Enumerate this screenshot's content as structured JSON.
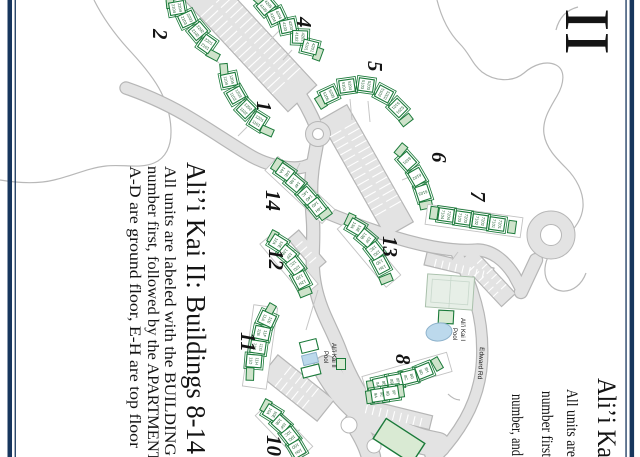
{
  "page": {
    "width": 640,
    "height": 457,
    "background": "#ffffff",
    "rotation_note": "portrait scan rotated 90deg clockwise"
  },
  "colors": {
    "border_navy": "#17365d",
    "building_green": "#1b7a3a",
    "unit_text_green": "#1d5c2f",
    "cap_green_fill": "#cfe3cb",
    "light_green_fill": "#d9ead3",
    "road_fill": "#e3e3e3",
    "road_casing": "#b6b6b6",
    "coast_gray": "#b8b8b8",
    "pool_blue": "#bcd9ec",
    "text_black": "#141414"
  },
  "left_legend": {
    "title": "Ali’i Kai II: Buildings 8-14",
    "lines": [
      "All units are labeled with the BUILDING",
      "number first, followed by the APARTMENT",
      "A-D are ground floor, E-H are top floor"
    ]
  },
  "right_page_fragment": {
    "numeral": "II",
    "title": "Ali’i Ka",
    "lines": [
      "All units are",
      "number first",
      "number, and"
    ]
  },
  "map_labels": {
    "pool1": [
      "Ali’i Kai I",
      "Pool"
    ],
    "pool2": [
      "Ali’i Kai II",
      "Pool"
    ],
    "road": "Edward Rd"
  },
  "labels": [
    {
      "name": "left-title",
      "text": "Ali’i Kai II: Buildings 8-14",
      "x": 187,
      "y": 162,
      "fs": 27,
      "rot": 90,
      "len": 292
    },
    {
      "name": "left-line-1",
      "text": "All units are labeled with the BUILDING",
      "x": 165,
      "y": 166,
      "fs": 15.5,
      "rot": 90,
      "len": 290
    },
    {
      "name": "left-line-2",
      "text": "number first, followed by the APARTMENT",
      "x": 148,
      "y": 166,
      "fs": 15.5,
      "rot": 90,
      "len": 296
    },
    {
      "name": "left-line-3",
      "text": "A-D are ground floor, E-H are top floor",
      "x": 130,
      "y": 166,
      "fs": 15.5,
      "rot": 90,
      "len": 282
    },
    {
      "name": "right-numeral",
      "text": "II",
      "x": 566,
      "y": 8,
      "fs": 64,
      "rot": 90,
      "len": 47
    },
    {
      "name": "right-title",
      "text": "Ali’i Ka",
      "x": 598,
      "y": 378,
      "fs": 26,
      "rot": 90,
      "len": 80
    },
    {
      "name": "right-line-1",
      "text": "All units are",
      "x": 567,
      "y": 389,
      "fs": 15.5,
      "rot": 90,
      "len": 68
    },
    {
      "name": "right-line-2",
      "text": "number first",
      "x": 542,
      "y": 391,
      "fs": 15.5,
      "rot": 90,
      "len": 66
    },
    {
      "name": "right-line-3",
      "text": "number, and",
      "x": 512,
      "y": 394,
      "fs": 15.5,
      "rot": 90,
      "len": 62
    },
    {
      "name": "bnum-2",
      "text": "2",
      "x": 153,
      "y": 29,
      "fs": 21,
      "rot": 90,
      "b": 1,
      "it": 1
    },
    {
      "name": "bnum-1",
      "text": "1",
      "x": 257,
      "y": 101,
      "fs": 21,
      "rot": 90,
      "b": 1,
      "it": 1
    },
    {
      "name": "bnum-4",
      "text": "4",
      "x": 297,
      "y": 17,
      "fs": 21,
      "rot": 90,
      "b": 1,
      "it": 1
    },
    {
      "name": "bnum-5",
      "text": "5",
      "x": 368,
      "y": 61,
      "fs": 21,
      "rot": 90,
      "b": 1,
      "it": 1
    },
    {
      "name": "bnum-6",
      "text": "6",
      "x": 432,
      "y": 152,
      "fs": 21,
      "rot": 90,
      "b": 1,
      "it": 1
    },
    {
      "name": "bnum-7",
      "text": "7",
      "x": 471,
      "y": 191,
      "fs": 21,
      "rot": 90,
      "b": 1,
      "it": 1
    },
    {
      "name": "bnum-14",
      "text": "14",
      "x": 266,
      "y": 190,
      "fs": 21,
      "rot": 90,
      "b": 1,
      "it": 1
    },
    {
      "name": "bnum-12",
      "text": "12",
      "x": 269,
      "y": 249,
      "fs": 21,
      "rot": 90,
      "b": 1,
      "it": 1
    },
    {
      "name": "bnum-13",
      "text": "13",
      "x": 383,
      "y": 236,
      "fs": 21,
      "rot": 90,
      "b": 1,
      "it": 1
    },
    {
      "name": "bnum-11",
      "text": "11",
      "x": 241,
      "y": 332,
      "fs": 21,
      "rot": 90,
      "b": 1,
      "it": 1
    },
    {
      "name": "bnum-8",
      "text": "8",
      "x": 396,
      "y": 354,
      "fs": 21,
      "rot": 90,
      "b": 1,
      "it": 1
    },
    {
      "name": "bnum-10",
      "text": "10",
      "x": 267,
      "y": 435,
      "fs": 21,
      "rot": 90,
      "b": 1,
      "it": 1
    },
    {
      "name": "pool1-label-1",
      "text": "Ali’i Kai I",
      "x": 461,
      "y": 318,
      "fs": 6,
      "rot": 90,
      "sans": 1
    },
    {
      "name": "pool1-label-2",
      "text": "Pool",
      "x": 453,
      "y": 328,
      "fs": 6,
      "rot": 90,
      "sans": 1
    },
    {
      "name": "pool2-label-1",
      "text": "Ali’i Kai II",
      "x": 332,
      "y": 343,
      "fs": 6,
      "rot": 90,
      "sans": 1
    },
    {
      "name": "pool2-label-2",
      "text": "Pool",
      "x": 324,
      "y": 351,
      "fs": 6,
      "rot": 90,
      "sans": 1
    },
    {
      "name": "edward-rd-label",
      "text": "Edward Rd",
      "x": 480,
      "y": 347,
      "fs": 6.5,
      "rot": 94,
      "sans": 1
    }
  ],
  "buildings": [
    {
      "id": "1",
      "units": [
        {
          "x": 229,
          "y": 80,
          "a": -12,
          "lines": [
            "1104",
            "1204"
          ]
        },
        {
          "x": 236,
          "y": 95,
          "a": -30,
          "lines": [
            "1103",
            "1203"
          ]
        },
        {
          "x": 246,
          "y": 109,
          "a": -45,
          "lines": [
            "1102",
            "1202"
          ]
        },
        {
          "x": 258,
          "y": 121,
          "a": -58,
          "lines": [
            "1101",
            "1201"
          ]
        }
      ],
      "caps": [
        {
          "x": 224,
          "y": 70,
          "a": -5
        },
        {
          "x": 267,
          "y": 131,
          "a": -66
        }
      ]
    },
    {
      "id": "2",
      "units": [
        {
          "x": 177,
          "y": 8,
          "a": -10,
          "lines": [
            "2104",
            "2204"
          ]
        },
        {
          "x": 187,
          "y": 19,
          "a": -25,
          "lines": [
            "2103",
            "2203"
          ]
        },
        {
          "x": 198,
          "y": 31,
          "a": -40,
          "lines": [
            "2102",
            "2202"
          ]
        },
        {
          "x": 207,
          "y": 44,
          "a": -55,
          "lines": [
            "2101",
            "2201"
          ]
        }
      ],
      "caps": [
        {
          "x": 170,
          "y": 2,
          "a": -5
        },
        {
          "x": 213,
          "y": 55,
          "a": -62
        }
      ]
    },
    {
      "id": "4",
      "units": [
        {
          "x": 266,
          "y": 6,
          "a": -40,
          "lines": [
            "4105",
            "4205"
          ]
        },
        {
          "x": 276,
          "y": 16,
          "a": -25,
          "lines": [
            "4104",
            "4204"
          ]
        },
        {
          "x": 288,
          "y": 26,
          "a": -12,
          "lines": [
            "4103",
            "4203"
          ]
        },
        {
          "x": 300,
          "y": 37,
          "a": 2,
          "lines": [
            "4102",
            "4202"
          ]
        },
        {
          "x": 310,
          "y": 47,
          "a": 14,
          "lines": [
            "4101",
            "4201"
          ]
        }
      ],
      "caps": [
        {
          "x": 259,
          "y": 0,
          "a": -48
        },
        {
          "x": 318,
          "y": 54,
          "a": 20
        }
      ]
    },
    {
      "id": "5",
      "units": [
        {
          "x": 329,
          "y": 95,
          "a": -25,
          "lines": [
            "5105",
            "5205"
          ]
        },
        {
          "x": 347,
          "y": 86,
          "a": -8,
          "lines": [
            "5104",
            "5204"
          ]
        },
        {
          "x": 366,
          "y": 85,
          "a": 8,
          "lines": [
            "5103",
            "5203"
          ]
        },
        {
          "x": 384,
          "y": 94,
          "a": 28,
          "lines": [
            "5102",
            "5202"
          ]
        },
        {
          "x": 398,
          "y": 108,
          "a": 45,
          "lines": [
            "5101",
            "5201"
          ]
        }
      ],
      "caps": [
        {
          "x": 321,
          "y": 102,
          "a": -32
        },
        {
          "x": 406,
          "y": 120,
          "a": 52
        }
      ]
    },
    {
      "id": "6",
      "units": [
        {
          "x": 407,
          "y": 161,
          "a": 48,
          "lines": [
            "6101"
          ]
        },
        {
          "x": 417,
          "y": 177,
          "a": 60,
          "lines": [
            "6102"
          ]
        },
        {
          "x": 423,
          "y": 193,
          "a": 72,
          "lines": [
            "6103"
          ]
        }
      ],
      "caps": [
        {
          "x": 401,
          "y": 150,
          "a": 40
        },
        {
          "x": 426,
          "y": 205,
          "a": 78
        }
      ]
    },
    {
      "id": "7",
      "pad": {
        "x": 474,
        "y": 221,
        "w": 96,
        "h": 20,
        "a": 8
      },
      "units": [
        {
          "x": 446,
          "y": 215,
          "a": 8,
          "lines": [
            "7104",
            "7204"
          ]
        },
        {
          "x": 463,
          "y": 218,
          "a": 8,
          "lines": [
            "7103",
            "7203"
          ]
        },
        {
          "x": 480,
          "y": 221,
          "a": 8,
          "lines": [
            "7102",
            "7202"
          ]
        },
        {
          "x": 497,
          "y": 224,
          "a": 8,
          "lines": [
            "7101",
            "7201"
          ]
        }
      ],
      "caps": [
        {
          "x": 434,
          "y": 213,
          "a": 8
        },
        {
          "x": 512,
          "y": 227,
          "a": 8
        }
      ]
    },
    {
      "id": "14",
      "pad": {
        "x": 300,
        "y": 190,
        "w": 78,
        "h": 19,
        "a": 43
      },
      "units": [
        {
          "x": 285,
          "y": 172,
          "a": 35,
          "lines": [
            "14A",
            "14E"
          ]
        },
        {
          "x": 295,
          "y": 183,
          "a": 40,
          "lines": [
            "14B",
            "14F"
          ]
        },
        {
          "x": 307,
          "y": 196,
          "a": 48,
          "lines": [
            "14C",
            "14G"
          ]
        },
        {
          "x": 317,
          "y": 207,
          "a": 52,
          "lines": [
            "14D",
            "14H"
          ]
        }
      ],
      "caps": [
        {
          "x": 277,
          "y": 165,
          "a": 32
        },
        {
          "x": 325,
          "y": 214,
          "a": 55
        }
      ]
    },
    {
      "id": "13",
      "pad": {
        "x": 369,
        "y": 252,
        "w": 76,
        "h": 19,
        "a": 50
      },
      "units": [
        {
          "x": 356,
          "y": 227,
          "a": 30,
          "lines": [
            "13A",
            "13E"
          ]
        },
        {
          "x": 366,
          "y": 238,
          "a": 40,
          "lines": [
            "13B",
            "13F"
          ]
        },
        {
          "x": 375,
          "y": 251,
          "a": 52,
          "lines": [
            "13C",
            "13G"
          ]
        },
        {
          "x": 381,
          "y": 265,
          "a": 62,
          "lines": [
            "13D",
            "13H"
          ]
        }
      ],
      "caps": [
        {
          "x": 350,
          "y": 220,
          "a": 25
        },
        {
          "x": 386,
          "y": 279,
          "a": 68
        }
      ]
    },
    {
      "id": "12",
      "pad": {
        "x": 289,
        "y": 264,
        "w": 68,
        "h": 19,
        "a": 50
      },
      "units": [
        {
          "x": 278,
          "y": 243,
          "a": 32,
          "lines": [
            "12A",
            "12E"
          ]
        },
        {
          "x": 287,
          "y": 254,
          "a": 40,
          "lines": [
            "12B",
            "12F"
          ]
        },
        {
          "x": 295,
          "y": 266,
          "a": 52,
          "lines": [
            "12C",
            "12G"
          ]
        },
        {
          "x": 301,
          "y": 280,
          "a": 62,
          "lines": [
            "12D",
            "12H"
          ]
        }
      ],
      "caps": [
        {
          "x": 273,
          "y": 237,
          "a": 28
        },
        {
          "x": 305,
          "y": 292,
          "a": 68
        }
      ]
    },
    {
      "id": "11",
      "pad": {
        "x": 260,
        "y": 347,
        "w": 24,
        "h": 82,
        "a": 8,
        "vert": 1
      },
      "units": [
        {
          "x": 267,
          "y": 319,
          "a": 25,
          "lines": [
            "11A",
            "11E"
          ]
        },
        {
          "x": 262,
          "y": 333,
          "a": 12,
          "lines": [
            "11B",
            "11F"
          ]
        },
        {
          "x": 258,
          "y": 347,
          "a": 8,
          "lines": [
            "11C",
            "11G"
          ]
        },
        {
          "x": 254,
          "y": 361,
          "a": 5,
          "lines": [
            "11D",
            "11H"
          ]
        }
      ],
      "caps": [
        {
          "x": 270,
          "y": 310,
          "a": 30
        },
        {
          "x": 250,
          "y": 374,
          "a": 2
        }
      ]
    },
    {
      "id": "8",
      "pad": {
        "x": 407,
        "y": 374,
        "w": 88,
        "h": 20,
        "a": -16
      },
      "units": [
        {
          "x": 381,
          "y": 384,
          "a": -12,
          "lines": [
            "8A",
            "8E"
          ]
        },
        {
          "x": 395,
          "y": 381,
          "a": -10,
          "lines": [
            "8B",
            "8F"
          ]
        },
        {
          "x": 409,
          "y": 377,
          "a": -14,
          "lines": [
            "8C",
            "8G"
          ]
        },
        {
          "x": 424,
          "y": 371,
          "a": -22,
          "lines": [
            "8D",
            "8H"
          ]
        }
      ],
      "caps": [
        {
          "x": 371,
          "y": 387,
          "a": -8
        },
        {
          "x": 437,
          "y": 364,
          "a": -30
        }
      ]
    },
    {
      "id": "9",
      "units": [
        {
          "x": 379,
          "y": 395,
          "a": -8,
          "lines": [
            "9A",
            "9E"
          ]
        },
        {
          "x": 391,
          "y": 393,
          "a": -8,
          "lines": [
            "9B",
            "9F"
          ]
        }
      ],
      "caps": [
        {
          "x": 370,
          "y": 397,
          "a": -8
        },
        {
          "x": 400,
          "y": 391,
          "a": -8
        }
      ]
    },
    {
      "id": "10",
      "pad": {
        "x": 284,
        "y": 431,
        "w": 62,
        "h": 20,
        "a": 46
      },
      "units": [
        {
          "x": 272,
          "y": 413,
          "a": 32,
          "lines": [
            "10A",
            "10E"
          ]
        },
        {
          "x": 281,
          "y": 424,
          "a": 42,
          "lines": [
            "10B",
            "10F"
          ]
        },
        {
          "x": 290,
          "y": 436,
          "a": 52,
          "lines": [
            "10C",
            "10G"
          ]
        },
        {
          "x": 297,
          "y": 449,
          "a": 60,
          "lines": [
            "10D",
            "10H"
          ]
        }
      ],
      "caps": [
        {
          "x": 266,
          "y": 406,
          "a": 28
        }
      ]
    }
  ]
}
